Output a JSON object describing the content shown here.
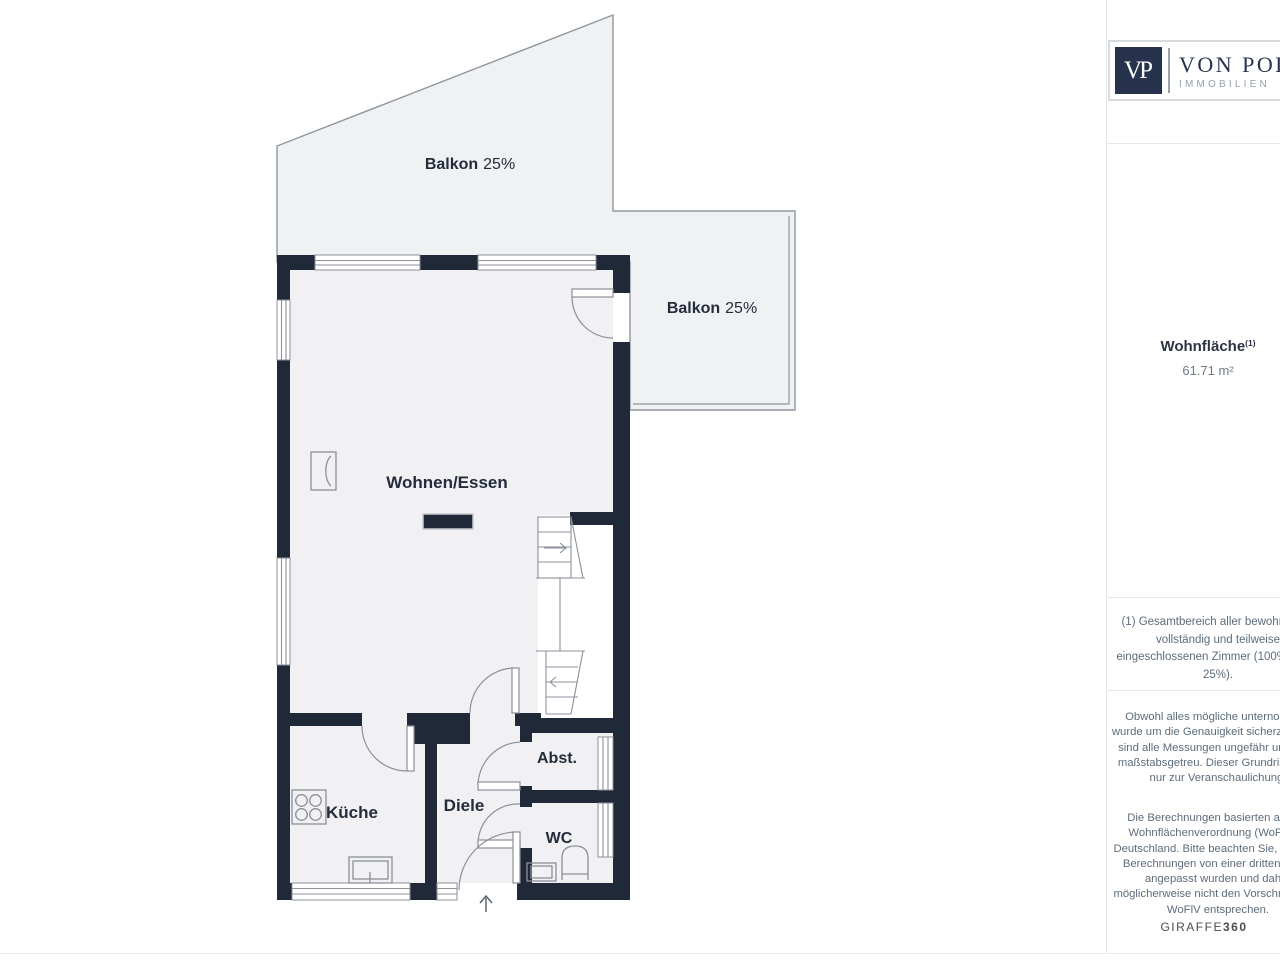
{
  "branding": {
    "monogram": "VP",
    "name": "VON POLL",
    "subtitle": "IMMOBILIEN"
  },
  "sidebar": {
    "area_label": "Wohnfläche",
    "area_footnote_mark": "(1)",
    "area_value": "61.71 m²",
    "notes": {
      "note1": "(1) Gesamtbereich aller bewohnbaren vollständig und teilweise eingeschlossenen Zimmer (100%, 50%, 25%).",
      "note2": "Obwohl alles mögliche unternommen wurde um die Genauigkeit sicherzustellen, sind alle Messungen ungefähr und nicht maßstabsgetreu. Dieser Grundriss dient nur zur Veranschaulichung.",
      "note3": "Die Berechnungen basierten auf der Wohnflächenverordnung (WoFlV) in Deutschland. Bitte beachten Sie, dass die Berechnungen von einer dritten Partei angepasst wurden und daher möglicherweise nicht den Vorschriften der WoFlV entsprechen."
    },
    "watermark": {
      "brand": "GIRAFFE",
      "suffix": "360"
    }
  },
  "floorplan": {
    "rooms": {
      "balcony_top": {
        "name": "Balkon",
        "share": "25%"
      },
      "balcony_right": {
        "name": "Balkon",
        "share": "25%"
      },
      "living": {
        "name": "Wohnen/Essen"
      },
      "kitchen": {
        "name": "Küche"
      },
      "hallway": {
        "name": "Diele"
      },
      "storage": {
        "name": "Abst."
      },
      "wc": {
        "name": "WC"
      }
    },
    "colors": {
      "wall": "#202938",
      "room_fill": "#f1f1f3",
      "balcony_fill": "#f0f1f2",
      "outline": "#9097a0",
      "line": "#8b9099",
      "label": "#242c3c"
    }
  }
}
